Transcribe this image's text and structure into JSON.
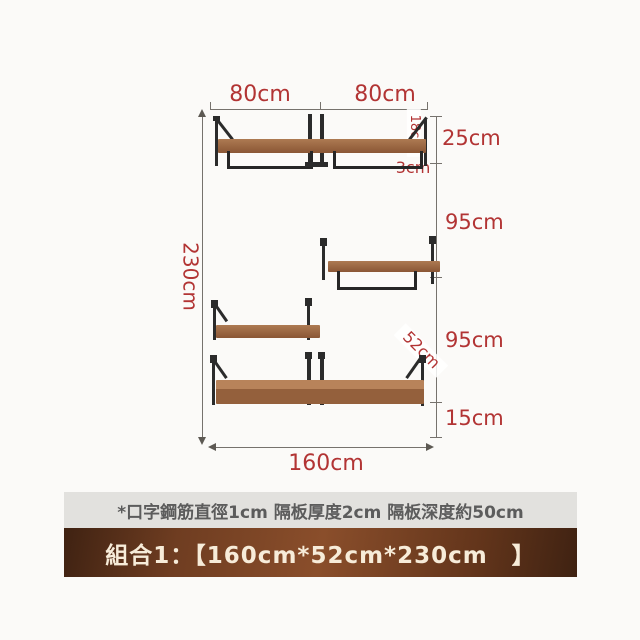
{
  "dimensions": {
    "top_left_width": "80cm",
    "top_right_width": "80cm",
    "overall_height": "230cm",
    "overall_width": "160cm",
    "segment_top": "25cm",
    "segment_upper_gap": "95cm",
    "segment_lower_gap": "95cm",
    "segment_bottom": "15cm",
    "bracket_height": "18cm",
    "rail_drop": "3cm",
    "shelf_depth": "52cm"
  },
  "note": {
    "text": "*口字鋼筋直徑1cm 隔板厚度2cm 隔板深度約50cm"
  },
  "banner": {
    "text": "組合1：【160cm*52cm*230cm　】"
  },
  "colors": {
    "dimension_text": "#b23434",
    "dimension_line": "#76726d",
    "wood_light": "#b8835a",
    "wood_dark": "#8a5635",
    "metal": "#2b2b2b",
    "note_bg": "#e2e1de",
    "note_text": "#5c5c5c",
    "banner_bg_dark": "#3f2212",
    "banner_bg_light": "#8a4e2b",
    "banner_text": "#f7ecd9",
    "page_bg": "#fbfaf8"
  }
}
